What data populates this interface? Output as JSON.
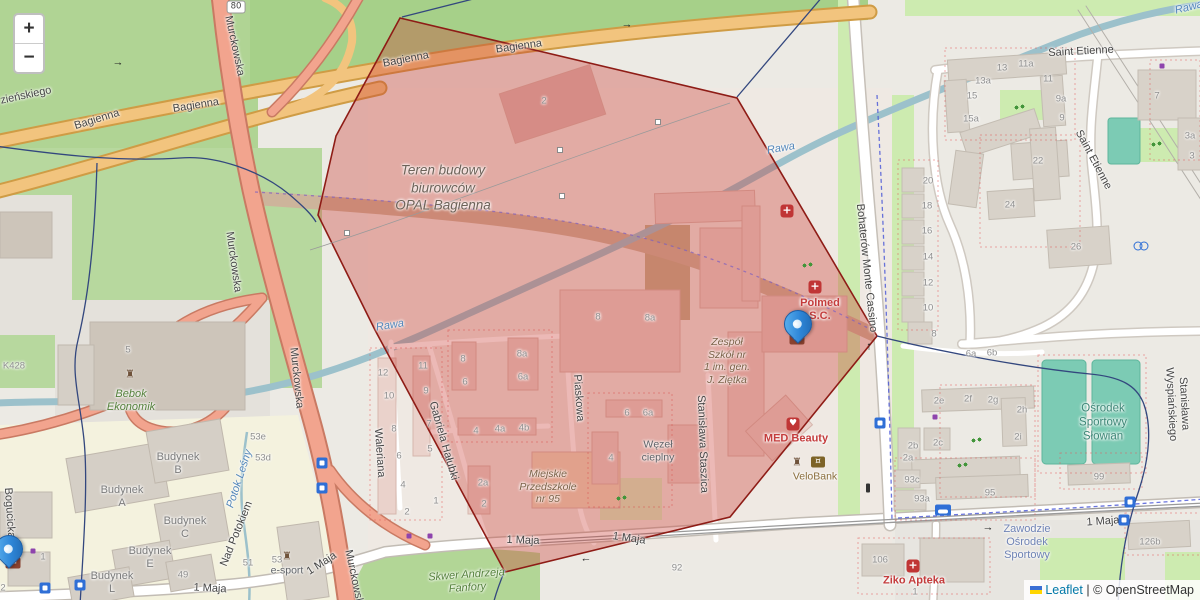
{
  "map": {
    "zoom_control": {
      "zoom_in": "+",
      "zoom_out": "−"
    },
    "attribution": {
      "leaflet": "Leaflet",
      "separator": " | ",
      "copyright": "© OpenStreetMap"
    },
    "colors": {
      "red_zone": "rgba(203,62,53,0.36)",
      "red_zone_border": "#8e1c16",
      "boundary": "#33477e",
      "parking_blue": "#2f6fd6",
      "transit_blue": "#2f6fd6",
      "medical_red": "#c03535",
      "poi_red": "#c43c3c",
      "poi_brown": "#8a6d3b",
      "poi_green": "#55813c",
      "poi_teal": "#3e8777",
      "poi_blue": "#6f83b5",
      "poi_gray": "#5f6368",
      "school_brown": "#7c6248",
      "construction_label": "#6d6258",
      "number_gray": "#8f8f8f",
      "street_label": "#454545",
      "water_label": "#5588bb",
      "budynek_gray": "#7b7b7b",
      "marker_blue": "#2e86d8",
      "link_blue": "#0078a8"
    },
    "labels": [
      {
        "t": "Bagienna",
        "x": 97,
        "y": 120,
        "r": -17,
        "c": "st"
      },
      {
        "t": "Bagienna",
        "x": 196,
        "y": 106,
        "r": -9,
        "c": "st"
      },
      {
        "t": "Bagienna",
        "x": 406,
        "y": 60,
        "r": -11,
        "c": "st"
      },
      {
        "t": "Bagienna",
        "x": 519,
        "y": 47,
        "r": -8,
        "c": "st"
      },
      {
        "t": "zieńskiego",
        "x": 26,
        "y": 96,
        "r": -12,
        "c": "st"
      },
      {
        "t": "Murckowska",
        "x": 234,
        "y": 46,
        "r": 78,
        "c": "st"
      },
      {
        "t": "Murckowska",
        "x": 233,
        "y": 262,
        "r": 82,
        "c": "st"
      },
      {
        "t": "Murckowska",
        "x": 296,
        "y": 378,
        "r": 84,
        "c": "st"
      },
      {
        "t": "Murckowska",
        "x": 354,
        "y": 580,
        "r": 78,
        "c": "st"
      },
      {
        "t": "Waleriana",
        "x": 379,
        "y": 453,
        "r": 86,
        "c": "st"
      },
      {
        "t": "Gabriela Hałubki",
        "x": 443,
        "y": 441,
        "r": 74,
        "c": "st"
      },
      {
        "t": "Piaskowa",
        "x": 578,
        "y": 398,
        "r": 86,
        "c": "st"
      },
      {
        "t": "Stanisława Staszica",
        "x": 702,
        "y": 444,
        "r": 88,
        "c": "st"
      },
      {
        "t": "Bohaterów Monte Cassino",
        "x": 866,
        "y": 268,
        "r": 84,
        "c": "st"
      },
      {
        "t": "Stanisława Wyspiańskiego",
        "x": 1177,
        "y": 404,
        "r": 87,
        "c": "st"
      },
      {
        "t": "Saint Etienne",
        "x": 1081,
        "y": 52,
        "r": -3,
        "c": "st"
      },
      {
        "t": "Saint Etienne",
        "x": 1093,
        "y": 160,
        "r": 62,
        "c": "st"
      },
      {
        "t": "1 Maja",
        "x": 523,
        "y": 541,
        "r": 2,
        "c": "st"
      },
      {
        "t": "1 Maja",
        "x": 629,
        "y": 539,
        "r": 8,
        "c": "st"
      },
      {
        "t": "1 Maja",
        "x": 1103,
        "y": 522,
        "r": -4,
        "c": "st"
      },
      {
        "t": "1 Maja",
        "x": 210,
        "y": 589,
        "r": 3,
        "c": "st"
      },
      {
        "t": "1 Maja",
        "x": 322,
        "y": 564,
        "r": -33,
        "c": "st"
      },
      {
        "t": "Nad Potokiem",
        "x": 237,
        "y": 534,
        "r": -68,
        "c": "st"
      },
      {
        "t": "Bogucicka",
        "x": 9,
        "y": 513,
        "r": 86,
        "c": "st"
      },
      {
        "t": "Rawa",
        "x": 781,
        "y": 149,
        "r": -10,
        "c": "wt"
      },
      {
        "t": "Rawa",
        "x": 390,
        "y": 326,
        "r": -9,
        "c": "wt"
      },
      {
        "t": "Rawa",
        "x": 1189,
        "y": 8,
        "r": -14,
        "c": "wt"
      },
      {
        "t": "Potok Leśny",
        "x": 240,
        "y": 479,
        "r": -72,
        "c": "wt"
      },
      {
        "t": "Teren budowy\nbiurowców\nOPAL Bagienna",
        "x": 443,
        "y": 188,
        "c": "con"
      },
      {
        "t": "Zespół\nSzkół nr\n1 im. gen.\nJ. Ziętka",
        "x": 727,
        "y": 361,
        "c": "sch"
      },
      {
        "t": "Miejskie\nPrzedszkole\nnr 95",
        "x": 548,
        "y": 487,
        "c": "sch"
      },
      {
        "t": "Węzeł\ncieplny",
        "x": 658,
        "y": 451,
        "c": "grayp"
      },
      {
        "t": "Ośrodek\nSportowy\nSłowian",
        "x": 1103,
        "y": 423,
        "c": "teal"
      },
      {
        "t": "Skwer Andrzeja\nFanfory",
        "x": 467,
        "y": 582,
        "r": -4,
        "c": "grn"
      },
      {
        "t": "Zawodzie\nOśrodek\nSportowy",
        "x": 1027,
        "y": 543,
        "c": "bluep"
      },
      {
        "t": "Ziko Apteka",
        "x": 914,
        "y": 581,
        "c": "redp"
      },
      {
        "t": "MED Beauty",
        "x": 796,
        "y": 439,
        "c": "redp"
      },
      {
        "t": "VeloBank",
        "x": 815,
        "y": 477,
        "c": "brown"
      },
      {
        "t": "Polmed\nS.C.",
        "x": 820,
        "y": 310,
        "c": "redp"
      },
      {
        "t": "Bebok\nEkonomik",
        "x": 131,
        "y": 401,
        "c": "grn"
      },
      {
        "t": "e-sport",
        "x": 287,
        "y": 571,
        "c": "grayp"
      },
      {
        "t": "Budynek\nA",
        "x": 122,
        "y": 497,
        "c": "bdg"
      },
      {
        "t": "Budynek\nB",
        "x": 178,
        "y": 464,
        "c": "bdg"
      },
      {
        "t": "Budynek\nC",
        "x": 185,
        "y": 528,
        "c": "bdg"
      },
      {
        "t": "Budynek\nE",
        "x": 150,
        "y": 558,
        "c": "bdg"
      },
      {
        "t": "Budynek\nL",
        "x": 112,
        "y": 583,
        "c": "bdg"
      },
      {
        "t": "12",
        "x": 383,
        "y": 373,
        "c": "num"
      },
      {
        "t": "10",
        "x": 389,
        "y": 396,
        "c": "num"
      },
      {
        "t": "8",
        "x": 394,
        "y": 429,
        "c": "num"
      },
      {
        "t": "6",
        "x": 399,
        "y": 456,
        "c": "num"
      },
      {
        "t": "4",
        "x": 403,
        "y": 485,
        "c": "num"
      },
      {
        "t": "2",
        "x": 407,
        "y": 512,
        "c": "num"
      },
      {
        "t": "11",
        "x": 423,
        "y": 366,
        "c": "num"
      },
      {
        "t": "9",
        "x": 426,
        "y": 391,
        "c": "num"
      },
      {
        "t": "7",
        "x": 429,
        "y": 424,
        "c": "num"
      },
      {
        "t": "5",
        "x": 430,
        "y": 449,
        "c": "num"
      },
      {
        "t": "1",
        "x": 436,
        "y": 501,
        "c": "num"
      },
      {
        "t": "8",
        "x": 463,
        "y": 359,
        "c": "num"
      },
      {
        "t": "6",
        "x": 465,
        "y": 382,
        "c": "num"
      },
      {
        "t": "8a",
        "x": 522,
        "y": 354,
        "c": "num"
      },
      {
        "t": "6a",
        "x": 523,
        "y": 377,
        "c": "num"
      },
      {
        "t": "4",
        "x": 476,
        "y": 431,
        "c": "num"
      },
      {
        "t": "4a",
        "x": 500,
        "y": 429,
        "c": "num"
      },
      {
        "t": "4b",
        "x": 524,
        "y": 428,
        "c": "num"
      },
      {
        "t": "2a",
        "x": 483,
        "y": 483,
        "c": "num"
      },
      {
        "t": "2",
        "x": 484,
        "y": 504,
        "c": "num"
      },
      {
        "t": "6",
        "x": 627,
        "y": 413,
        "c": "num"
      },
      {
        "t": "6a",
        "x": 648,
        "y": 413,
        "c": "num"
      },
      {
        "t": "4",
        "x": 611,
        "y": 458,
        "c": "num"
      },
      {
        "t": "8",
        "x": 598,
        "y": 317,
        "c": "num"
      },
      {
        "t": "8a",
        "x": 650,
        "y": 318,
        "c": "num"
      },
      {
        "t": "2",
        "x": 544,
        "y": 101,
        "c": "num"
      },
      {
        "t": "13",
        "x": 1002,
        "y": 68,
        "c": "num"
      },
      {
        "t": "13a",
        "x": 983,
        "y": 81,
        "c": "num"
      },
      {
        "t": "11a",
        "x": 1026,
        "y": 64,
        "c": "num"
      },
      {
        "t": "11",
        "x": 1048,
        "y": 79,
        "c": "num"
      },
      {
        "t": "15",
        "x": 972,
        "y": 96,
        "c": "num"
      },
      {
        "t": "15a",
        "x": 971,
        "y": 119,
        "c": "num"
      },
      {
        "t": "9a",
        "x": 1061,
        "y": 99,
        "c": "num"
      },
      {
        "t": "9",
        "x": 1062,
        "y": 118,
        "c": "num"
      },
      {
        "t": "22",
        "x": 1038,
        "y": 161,
        "c": "num"
      },
      {
        "t": "7",
        "x": 1157,
        "y": 96,
        "c": "num"
      },
      {
        "t": "3a",
        "x": 1190,
        "y": 136,
        "c": "num"
      },
      {
        "t": "3",
        "x": 1192,
        "y": 156,
        "c": "num"
      },
      {
        "t": "24",
        "x": 1010,
        "y": 205,
        "c": "num"
      },
      {
        "t": "26",
        "x": 1076,
        "y": 247,
        "c": "num"
      },
      {
        "t": "20",
        "x": 928,
        "y": 181,
        "c": "num"
      },
      {
        "t": "18",
        "x": 927,
        "y": 206,
        "c": "num"
      },
      {
        "t": "16",
        "x": 927,
        "y": 231,
        "c": "num"
      },
      {
        "t": "14",
        "x": 928,
        "y": 257,
        "c": "num"
      },
      {
        "t": "12",
        "x": 928,
        "y": 283,
        "c": "num"
      },
      {
        "t": "10",
        "x": 928,
        "y": 308,
        "c": "num"
      },
      {
        "t": "8",
        "x": 934,
        "y": 334,
        "c": "num"
      },
      {
        "t": "6a",
        "x": 971,
        "y": 354,
        "c": "num"
      },
      {
        "t": "6b",
        "x": 992,
        "y": 353,
        "c": "num"
      },
      {
        "t": "2e",
        "x": 939,
        "y": 401,
        "c": "num"
      },
      {
        "t": "2f",
        "x": 968,
        "y": 399,
        "c": "num"
      },
      {
        "t": "2g",
        "x": 993,
        "y": 400,
        "c": "num"
      },
      {
        "t": "2h",
        "x": 1022,
        "y": 410,
        "c": "num"
      },
      {
        "t": "2i",
        "x": 1018,
        "y": 437,
        "c": "num"
      },
      {
        "t": "2b",
        "x": 913,
        "y": 446,
        "c": "num"
      },
      {
        "t": "2a",
        "x": 908,
        "y": 458,
        "c": "num"
      },
      {
        "t": "2c",
        "x": 938,
        "y": 443,
        "c": "num"
      },
      {
        "t": "93c",
        "x": 912,
        "y": 480,
        "c": "num"
      },
      {
        "t": "93a",
        "x": 922,
        "y": 499,
        "c": "num"
      },
      {
        "t": "95",
        "x": 990,
        "y": 493,
        "c": "num"
      },
      {
        "t": "99",
        "x": 1099,
        "y": 477,
        "c": "num"
      },
      {
        "t": "106",
        "x": 880,
        "y": 560,
        "c": "num"
      },
      {
        "t": "1",
        "x": 915,
        "y": 592,
        "c": "num"
      },
      {
        "t": "126b",
        "x": 1150,
        "y": 542,
        "c": "num"
      },
      {
        "t": "92",
        "x": 677,
        "y": 568,
        "c": "num"
      },
      {
        "t": "5",
        "x": 128,
        "y": 350,
        "c": "num"
      },
      {
        "t": "49",
        "x": 183,
        "y": 575,
        "c": "num"
      },
      {
        "t": "51",
        "x": 248,
        "y": 563,
        "c": "num"
      },
      {
        "t": "53",
        "x": 277,
        "y": 560,
        "c": "num"
      },
      {
        "t": "53e",
        "x": 258,
        "y": 437,
        "c": "num"
      },
      {
        "t": "53d",
        "x": 263,
        "y": 458,
        "c": "num"
      },
      {
        "t": "1",
        "x": 43,
        "y": 557,
        "c": "num"
      },
      {
        "t": "2",
        "x": 3,
        "y": 588,
        "c": "num"
      },
      {
        "t": "K428",
        "x": 14,
        "y": 366,
        "c": "num"
      },
      {
        "t": "→",
        "x": 988,
        "y": 528,
        "c": "arw"
      },
      {
        "t": "→",
        "x": 627,
        "y": 25,
        "c": "arw"
      },
      {
        "t": "→",
        "x": 118,
        "y": 63,
        "c": "arw"
      },
      {
        "t": "↑",
        "x": 869,
        "y": 347,
        "c": "arw"
      },
      {
        "t": "←",
        "x": 586,
        "y": 559,
        "c": "arw"
      }
    ],
    "icons": [
      {
        "k": "P",
        "x": 786,
        "y": 286,
        "s": 15
      },
      {
        "k": "P",
        "x": 801,
        "y": 286,
        "s": 15
      },
      {
        "k": "P",
        "x": 559,
        "y": 383,
        "s": 13
      },
      {
        "k": "P",
        "x": 1015,
        "y": 350,
        "s": 13
      },
      {
        "k": "P",
        "x": 1031,
        "y": 355,
        "s": 13
      },
      {
        "k": "P",
        "x": 1086,
        "y": 99,
        "s": 13
      },
      {
        "k": "P",
        "x": 1118,
        "y": 91,
        "s": 13
      },
      {
        "k": "P",
        "x": 960,
        "y": 182,
        "s": 13
      },
      {
        "k": "P",
        "x": 1041,
        "y": 204,
        "s": 12
      },
      {
        "k": "P",
        "x": 1054,
        "y": 201,
        "s": 12
      },
      {
        "k": "P",
        "x": 1064,
        "y": 201,
        "s": 12
      },
      {
        "k": "P",
        "x": 1080,
        "y": 200,
        "s": 12
      },
      {
        "k": "P",
        "x": 1097,
        "y": 209,
        "s": 12
      },
      {
        "k": "P",
        "x": 1177,
        "y": 213,
        "s": 13
      },
      {
        "k": "P",
        "x": 1022,
        "y": 256,
        "s": 12
      },
      {
        "k": "P",
        "x": 1040,
        "y": 258,
        "s": 12
      },
      {
        "k": "P",
        "x": 1056,
        "y": 276,
        "s": 12
      },
      {
        "k": "P",
        "x": 1033,
        "y": 310,
        "s": 12
      },
      {
        "k": "P",
        "x": 1044,
        "y": 315,
        "s": 12
      },
      {
        "k": "P",
        "x": 1044,
        "y": 401,
        "s": 13
      },
      {
        "k": "P",
        "x": 1055,
        "y": 462,
        "s": 13
      },
      {
        "k": "P",
        "x": 1055,
        "y": 478,
        "s": 13
      },
      {
        "k": "P",
        "x": 905,
        "y": 408,
        "s": 12
      },
      {
        "k": "P",
        "x": 939,
        "y": 471,
        "s": 12
      },
      {
        "k": "P",
        "x": 1006,
        "y": 462,
        "s": 13
      },
      {
        "k": "P",
        "x": 955,
        "y": 536,
        "s": 13
      },
      {
        "k": "P",
        "x": 267,
        "y": 585,
        "s": 16
      },
      {
        "k": "P",
        "x": 188,
        "y": 347,
        "s": 14,
        "f": 1
      },
      {
        "k": "P",
        "x": 45,
        "y": 372,
        "s": 16,
        "f": 1
      },
      {
        "k": "P",
        "x": 128,
        "y": 465,
        "s": 10,
        "f": 1
      },
      {
        "k": "P",
        "x": 107,
        "y": 560,
        "s": 10,
        "f": 1
      },
      {
        "k": "taxi",
        "x": 943,
        "y": 510
      },
      {
        "k": "transit",
        "x": 1130,
        "y": 502
      },
      {
        "k": "transit",
        "x": 1124,
        "y": 520
      },
      {
        "k": "transit",
        "x": 880,
        "y": 423
      },
      {
        "k": "transit",
        "x": 80,
        "y": 585
      },
      {
        "k": "transit",
        "x": 45,
        "y": 588
      },
      {
        "k": "transit",
        "x": 322,
        "y": 463
      },
      {
        "k": "transit",
        "x": 322,
        "y": 488
      },
      {
        "k": "aid",
        "t": "+",
        "x": 815,
        "y": 287
      },
      {
        "k": "aid",
        "t": "+",
        "x": 787,
        "y": 211
      },
      {
        "k": "heart",
        "t": "♥",
        "x": 793,
        "y": 424
      },
      {
        "k": "cross",
        "t": "+",
        "x": 913,
        "y": 566
      },
      {
        "k": "post",
        "t": "✉",
        "x": 797,
        "y": 339
      },
      {
        "k": "post",
        "t": "✉",
        "x": 13,
        "y": 563
      },
      {
        "k": "bank",
        "t": "¤",
        "x": 818,
        "y": 462
      },
      {
        "k": "monument",
        "t": "♜",
        "x": 797,
        "y": 462
      },
      {
        "k": "monument",
        "t": "♜",
        "x": 130,
        "y": 374
      },
      {
        "k": "monument",
        "t": "♜",
        "x": 287,
        "y": 556
      },
      {
        "k": "playground",
        "x": 1020,
        "y": 107
      },
      {
        "k": "playground",
        "x": 1157,
        "y": 144
      },
      {
        "k": "playground",
        "x": 977,
        "y": 440
      },
      {
        "k": "playground",
        "x": 963,
        "y": 465
      },
      {
        "k": "playground",
        "x": 622,
        "y": 498
      },
      {
        "k": "playground",
        "x": 808,
        "y": 265
      },
      {
        "k": "bike",
        "x": 1141,
        "y": 245
      },
      {
        "k": "dotp",
        "x": 409,
        "y": 536
      },
      {
        "k": "dotp",
        "x": 430,
        "y": 536
      },
      {
        "k": "dotp",
        "x": 33,
        "y": 551
      },
      {
        "k": "dotp",
        "x": 935,
        "y": 417
      },
      {
        "k": "dotp",
        "x": 1162,
        "y": 66
      },
      {
        "k": "tl",
        "x": 868,
        "y": 488
      },
      {
        "k": "shield",
        "t": "80",
        "x": 236,
        "y": 7
      }
    ],
    "markers": [
      {
        "x": 797,
        "y": 341
      },
      {
        "x": 8,
        "y": 566
      }
    ]
  }
}
